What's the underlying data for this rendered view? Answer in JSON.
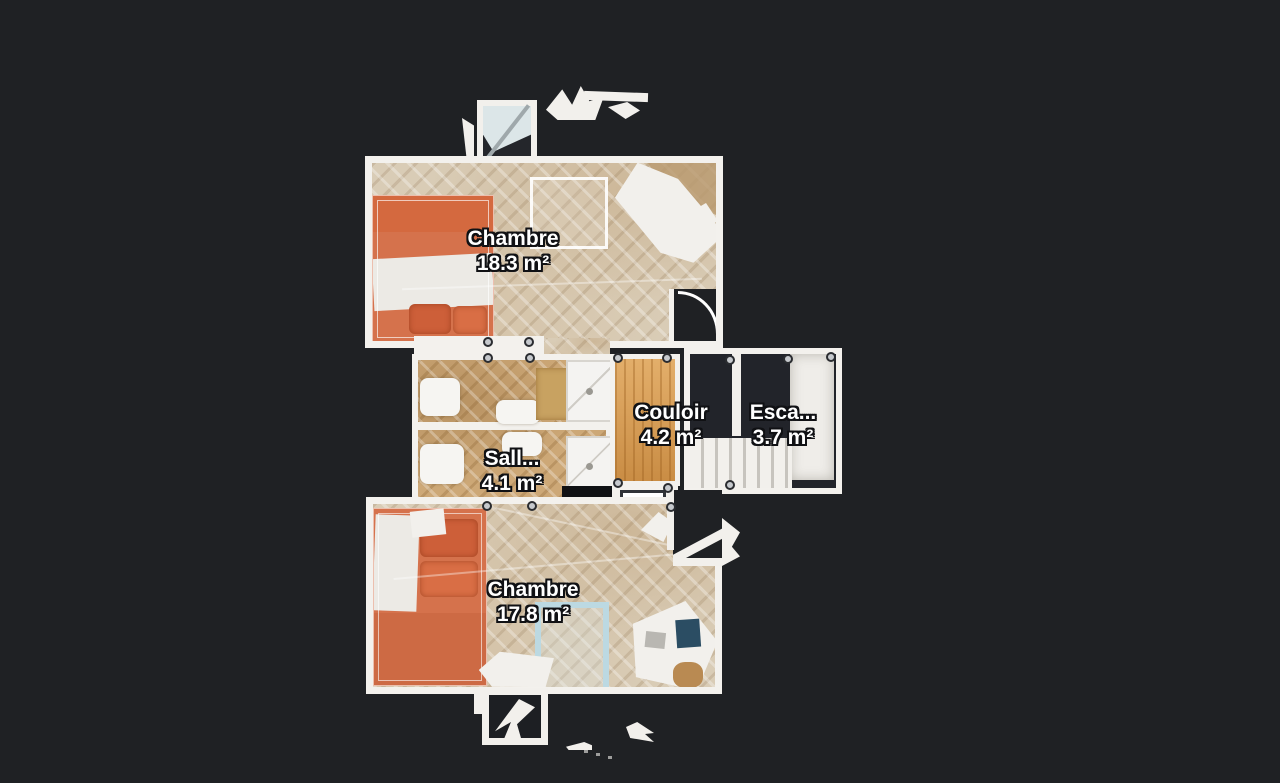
{
  "view": {
    "type": "floor-plan-scan",
    "background": "#1f2124"
  },
  "rooms": [
    {
      "id": "chambre-top",
      "name": "Chambre",
      "area": "18.3 m²"
    },
    {
      "id": "salle-de-bain",
      "name": "Sall...",
      "area": "4.1 m²"
    },
    {
      "id": "couloir",
      "name": "Couloir",
      "area": "4.2 m²"
    },
    {
      "id": "escalier",
      "name": "Esca...",
      "area": "3.7 m²"
    },
    {
      "id": "chambre-bottom",
      "name": "Chambre",
      "area": "17.8 m²"
    }
  ],
  "palette": {
    "background": "#1f2124",
    "wall": "#f3f1ed",
    "parquet": "#d9ccb6",
    "bathroom_floor": "#cda877",
    "corridor_wood": "#d79a4f",
    "bed_orange": "#d5724c",
    "rug_blue": "#bcd9e2",
    "laptop_blue": "#2b4d63",
    "label_text": "#ffffff",
    "label_outline": "#101114",
    "handle_fill": "#c6c9cd",
    "handle_ring": "#2a2c30"
  }
}
